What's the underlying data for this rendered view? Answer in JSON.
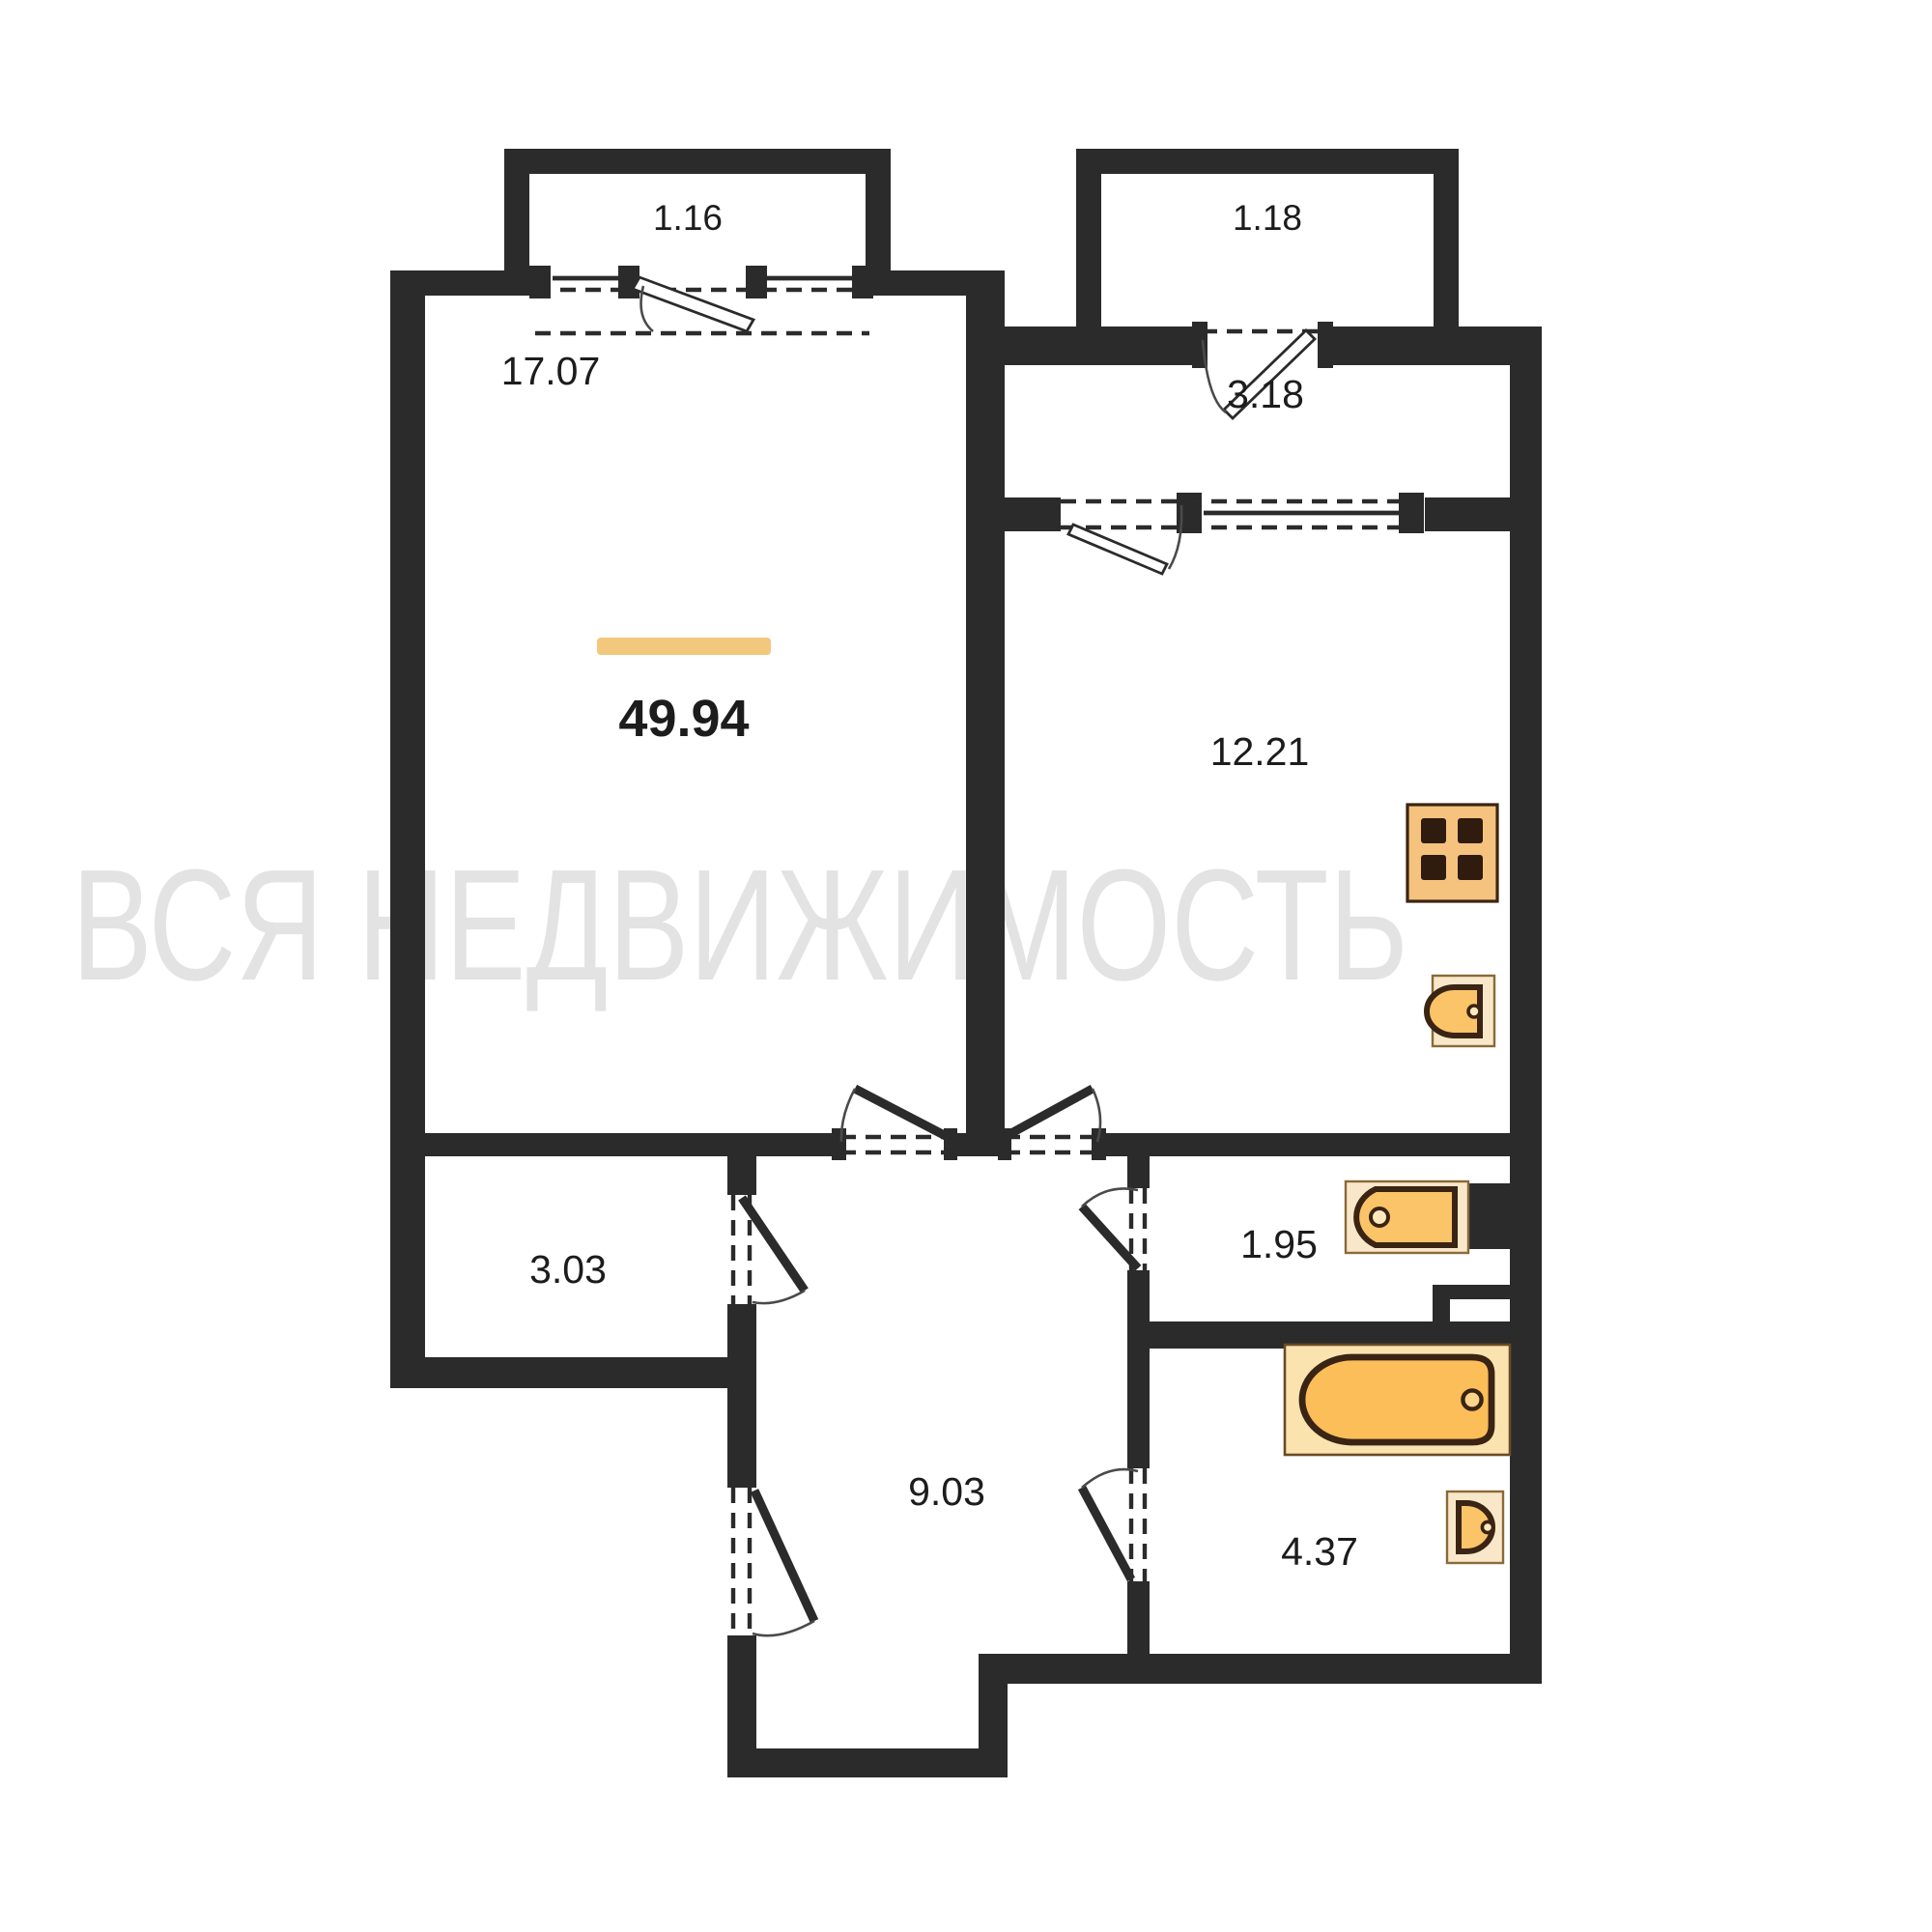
{
  "watermark": {
    "text": "ВСЯ НЕДВИЖИМОСТЬ",
    "color": "#e3e3e3"
  },
  "total": {
    "area": "49.94",
    "accent_color": "#f2c87c"
  },
  "rooms": [
    {
      "id": "balcony-left",
      "area": "1.16"
    },
    {
      "id": "balcony-right",
      "area": "1.18"
    },
    {
      "id": "living-room",
      "area": "17.07"
    },
    {
      "id": "vestibule",
      "area": "3.18"
    },
    {
      "id": "kitchen",
      "area": "12.21"
    },
    {
      "id": "closet",
      "area": "3.03"
    },
    {
      "id": "wc",
      "area": "1.95"
    },
    {
      "id": "hallway",
      "area": "9.03"
    },
    {
      "id": "bathroom",
      "area": "4.37"
    }
  ],
  "fixtures": [
    {
      "name": "stove"
    },
    {
      "name": "kitchen-sink"
    },
    {
      "name": "toilet"
    },
    {
      "name": "bathtub"
    },
    {
      "name": "bathroom-sink"
    }
  ],
  "colors": {
    "wall": "#2b2b2b",
    "fixture": "#fbc469",
    "fixture_light": "#f9e7c9",
    "fixture_outline": "#3a2413",
    "label": "#1c1c1c"
  }
}
